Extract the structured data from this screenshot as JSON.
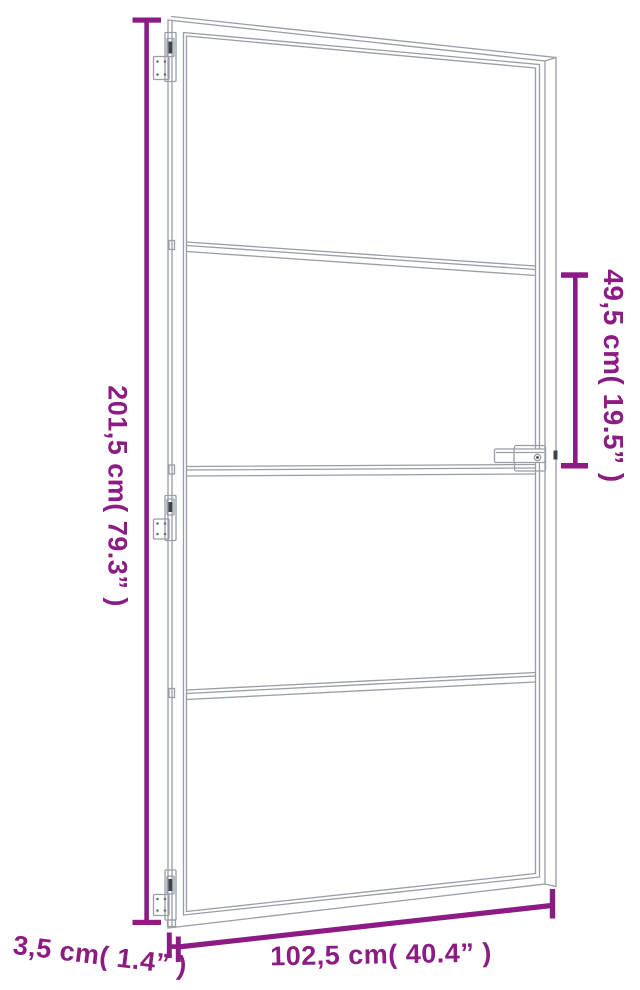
{
  "diagram": {
    "type": "product-dimension-diagram",
    "subject": "slim-frame interior glass door with three hinges and lever handle",
    "colors": {
      "dimension_annotation": "#8C1C83",
      "line_art": "#989EA6",
      "line_art_dark": "#3F444B",
      "background": "#FFFFFF"
    },
    "dimensions": {
      "door_height": {
        "label": "201,5 cm( 79.3” )",
        "value_cm": "201,5",
        "value_in": "79.3"
      },
      "handle_section": {
        "label": "49,5 cm( 19.5” )",
        "value_cm": "49,5",
        "value_in": "19.5"
      },
      "door_width": {
        "label": "102,5 cm( 40.4” )",
        "value_cm": "102,5",
        "value_in": "40.4"
      },
      "frame_thickness": {
        "label": "3,5 cm( 1.4” )",
        "value_cm": "3,5",
        "value_in": "1.4"
      }
    },
    "features": {
      "hinge_count": 3,
      "glass_sections": 4,
      "handle_side": "right"
    }
  }
}
